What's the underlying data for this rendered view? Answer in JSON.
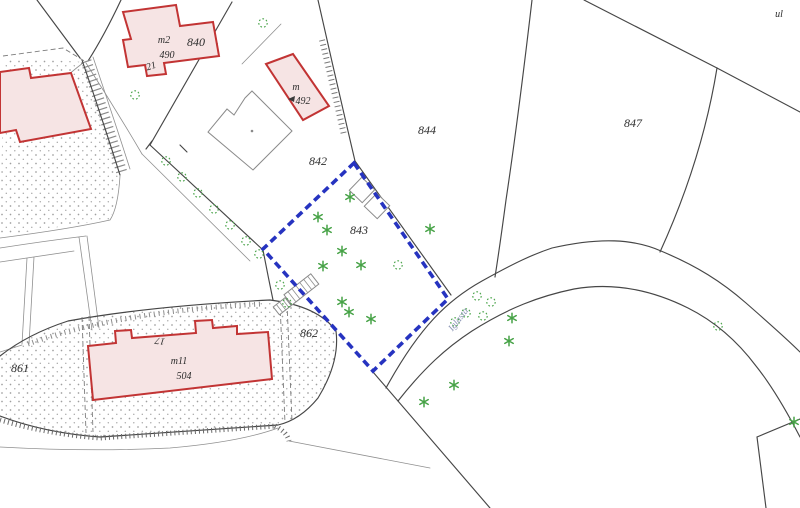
{
  "colors": {
    "subject": "#2633c0",
    "building_stroke": "#c23434",
    "building_fill": "#f6e4e4",
    "vegetation": "#46a246",
    "line": "#464646",
    "stipple": "#9f9f9f",
    "label": "#2b2b2b",
    "street_label": "#8b95b5"
  },
  "labels": {
    "street_prefix": "ul",
    "street_name": "Iglasta"
  },
  "parcels": [
    {
      "number": "840"
    },
    {
      "number": "842"
    },
    {
      "number": "843",
      "highlighted": true
    },
    {
      "number": "844"
    },
    {
      "number": "847"
    },
    {
      "number": "861"
    },
    {
      "number": "862"
    }
  ],
  "buildings": [
    {
      "code": "m2",
      "number": "490",
      "address_no": "21",
      "outline": "red"
    },
    {
      "code": "m",
      "number": "492",
      "outline": "red"
    },
    {
      "code": "m11",
      "number": "504",
      "address_no": "17",
      "outline": "red"
    }
  ],
  "vegetation": {
    "coniferous_tree_count": 15,
    "bush_count": 18
  },
  "map_type": "cadastral parcel map",
  "subject_parcel": "843"
}
